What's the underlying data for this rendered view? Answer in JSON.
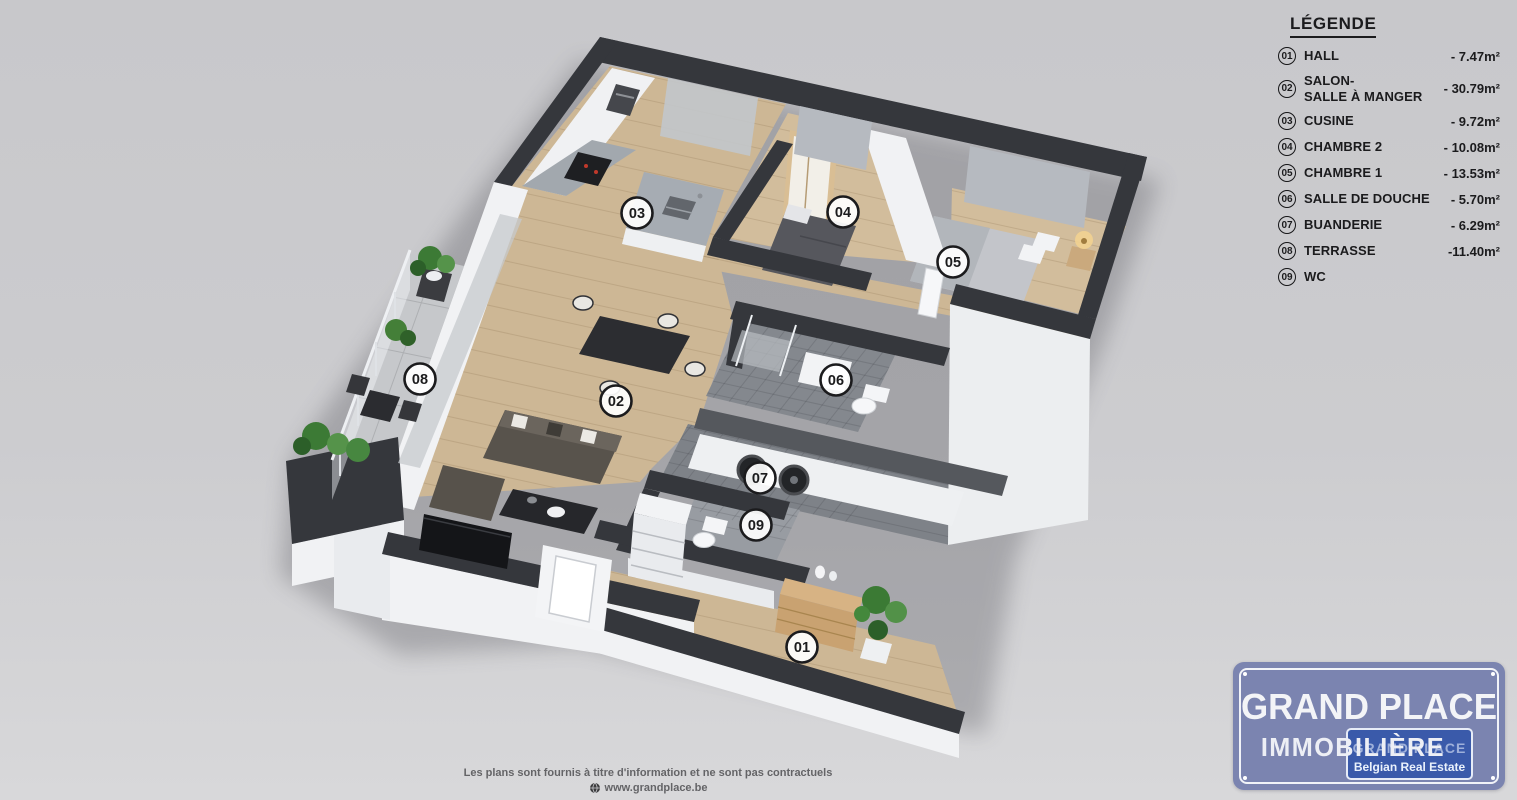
{
  "colors": {
    "background_top": "#c8c8cb",
    "background_bottom": "#d8d8da",
    "wall_dark": "#35373c",
    "white_wall": "#f1f2f4",
    "wood_floor": "#cdb795",
    "tile_floor": "#84888e",
    "terrace_tile": "#c6c8cb",
    "plant_green": "#3c7a35",
    "logo_plaque": "#7b84b0",
    "logo_badge": "#2c50a8"
  },
  "legend": {
    "title": "LÉGENDE",
    "items": [
      {
        "num": "01",
        "name": "HALL",
        "area": "- 7.47m²"
      },
      {
        "num": "02",
        "name": "SALON-\nSALLE À MANGER",
        "area": "- 30.79m²"
      },
      {
        "num": "03",
        "name": "CUSINE",
        "area": "- 9.72m²"
      },
      {
        "num": "04",
        "name": "CHAMBRE 2",
        "area": "- 10.08m²"
      },
      {
        "num": "05",
        "name": "CHAMBRE 1",
        "area": "- 13.53m²"
      },
      {
        "num": "06",
        "name": "SALLE DE DOUCHE",
        "area": "- 5.70m²"
      },
      {
        "num": "07",
        "name": "BUANDERIE",
        "area": "- 6.29m²"
      },
      {
        "num": "08",
        "name": "TERRASSE",
        "area": "-11.40m²"
      },
      {
        "num": "09",
        "name": "WC",
        "area": ""
      }
    ]
  },
  "plan": {
    "room_labels": [
      {
        "id": "hall",
        "num": "01"
      },
      {
        "id": "salon-salle-a-manger",
        "num": "02"
      },
      {
        "id": "cuisine",
        "num": "03"
      },
      {
        "id": "chambre-2",
        "num": "04"
      },
      {
        "id": "chambre-1",
        "num": "05"
      },
      {
        "id": "salle-de-douche",
        "num": "06"
      },
      {
        "id": "buanderie",
        "num": "07"
      },
      {
        "id": "terrasse",
        "num": "08"
      },
      {
        "id": "wc",
        "num": "09"
      }
    ]
  },
  "logo": {
    "line1": "GRAND PLACE",
    "line2": "IMMOBILIÈRE",
    "badge_line1": "GRAND PLACE",
    "badge_line2": "Belgian Real Estate"
  },
  "footer": {
    "disclaimer": "Les plans sont fournis à titre d'information et ne sont pas contractuels",
    "website": "www.grandplace.be"
  }
}
